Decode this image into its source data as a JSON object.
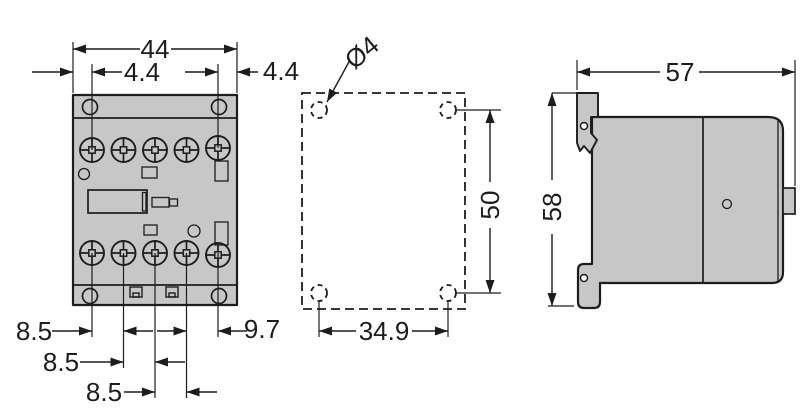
{
  "colors": {
    "body_fill": "#c7c7c7",
    "line": "#1d1d1b",
    "background": "#ffffff"
  },
  "dims": {
    "front_width": "44",
    "front_offset_left": "4.4",
    "front_offset_right": "4.4",
    "front_pitch_1": "8.5",
    "front_pitch_2": "8.5",
    "front_pitch_3": "8.5",
    "front_pitch_last": "9.7",
    "hole_diameter": "Ø4",
    "hole_spacing_vertical": "50",
    "hole_spacing_horizontal": "34.9",
    "side_depth": "57",
    "side_height": "58"
  }
}
